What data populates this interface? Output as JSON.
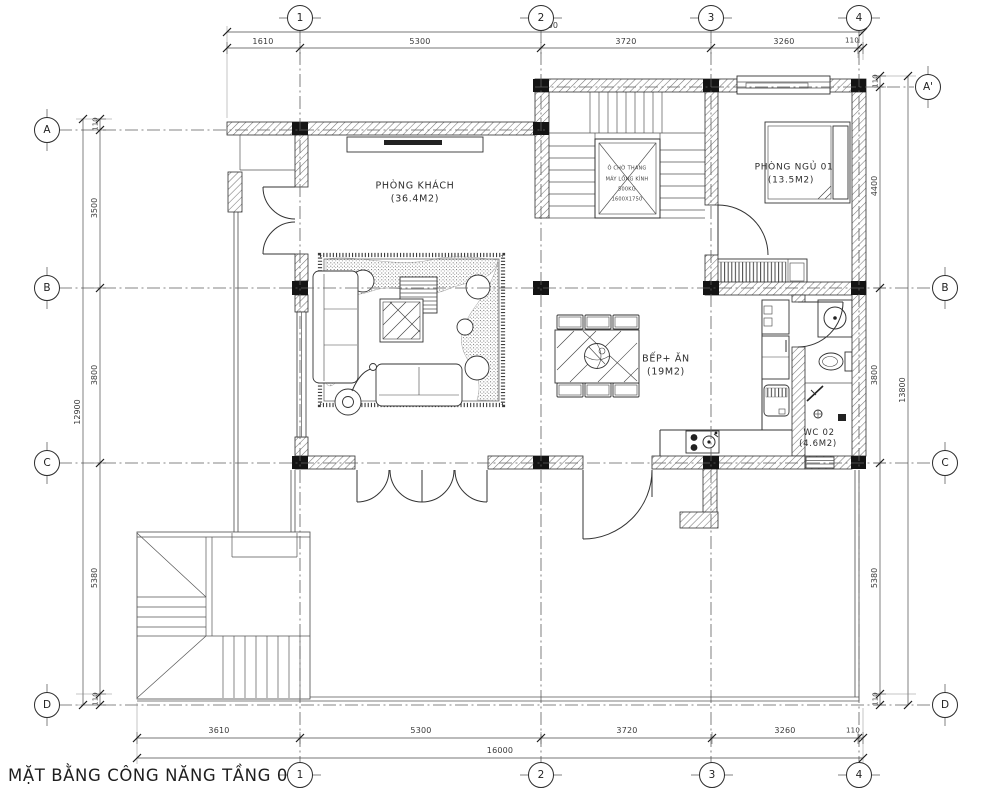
{
  "sheet": {
    "title": "MẶT BẰNG CÔNG NĂNG TẦNG 02"
  },
  "grid": {
    "cols": [
      "1",
      "2",
      "3",
      "4"
    ],
    "rows_left": [
      "A",
      "B",
      "C",
      "D"
    ],
    "rows_right": [
      "A'",
      "B",
      "C",
      "D"
    ]
  },
  "dims": {
    "top": {
      "total": "14000",
      "segments": [
        "1610",
        "5300",
        "3720",
        "3260",
        "110"
      ]
    },
    "bottom": {
      "total": "16000",
      "segments": [
        "3610",
        "5300",
        "3720",
        "3260",
        "110"
      ]
    },
    "left": {
      "total": "12900",
      "segments": [
        "110",
        "3500",
        "3800",
        "5380",
        "110"
      ]
    },
    "right": {
      "total": "13800",
      "segments": [
        "110",
        "4400",
        "3800",
        "5380",
        "110"
      ]
    }
  },
  "rooms": {
    "living": {
      "name": "PHÒNG KHÁCH",
      "area": "(36.4M2)"
    },
    "bedroom": {
      "name": "PHÒNG NGỦ 01",
      "area": "(13.5M2)"
    },
    "kitchen": {
      "name": "BẾP+ ĂN",
      "area": "(19M2)"
    },
    "wc": {
      "name": "WC 02",
      "area": "(4.6M2)"
    }
  },
  "elevator": {
    "line1": "Ô CHỜ THANG",
    "line2": "MÁY LỒNG KÍNH",
    "line3": "500KG",
    "line4": "1600X1750"
  }
}
